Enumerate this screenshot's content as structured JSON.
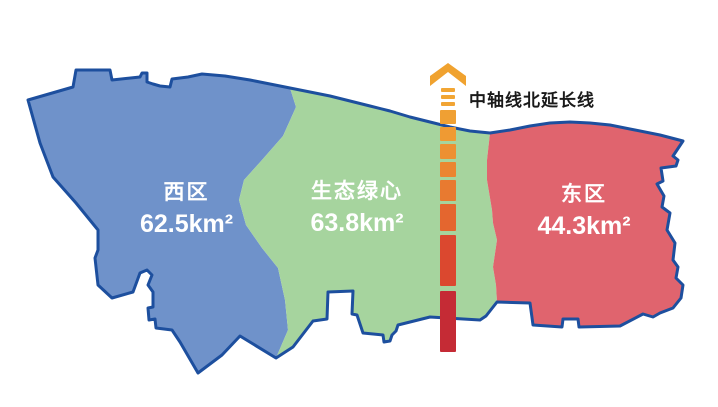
{
  "diagram": {
    "background": "#ffffff",
    "outline_color": "#1d4f9e",
    "label_text_color": "#ffffff"
  },
  "regions": {
    "west": {
      "name": "西区",
      "area": "62.5km²",
      "color": "#6f92ca"
    },
    "green_heart": {
      "name": "生态绿心",
      "area": "63.8km²",
      "color": "#a6d49e"
    },
    "east": {
      "name": "东区",
      "area": "44.3km²",
      "color": "#e0646e"
    }
  },
  "axis": {
    "label": "中轴线北延长线",
    "label_color": "#1a1a1a",
    "arrow_color": "#f0a22f",
    "dashes": [
      {
        "y": 88,
        "h": 4,
        "w": 14,
        "color": "#f2a634"
      },
      {
        "y": 95,
        "h": 4,
        "w": 14,
        "color": "#f2a634"
      },
      {
        "y": 102,
        "h": 4,
        "w": 14,
        "color": "#f1a434"
      },
      {
        "y": 110,
        "h": 14,
        "w": 16,
        "color": "#f0a033"
      },
      {
        "y": 127,
        "h": 14,
        "w": 16,
        "color": "#ef9a33"
      },
      {
        "y": 144,
        "h": 15,
        "w": 16,
        "color": "#ed9032"
      },
      {
        "y": 162,
        "h": 15,
        "w": 16,
        "color": "#eb8531"
      },
      {
        "y": 180,
        "h": 21,
        "w": 16,
        "color": "#e87a30"
      },
      {
        "y": 204,
        "h": 27,
        "w": 16,
        "color": "#e4662f"
      },
      {
        "y": 235,
        "h": 51,
        "w": 16,
        "color": "#db482f"
      },
      {
        "y": 291,
        "h": 61,
        "w": 16,
        "color": "#c52b35"
      }
    ],
    "center_x": 448
  }
}
